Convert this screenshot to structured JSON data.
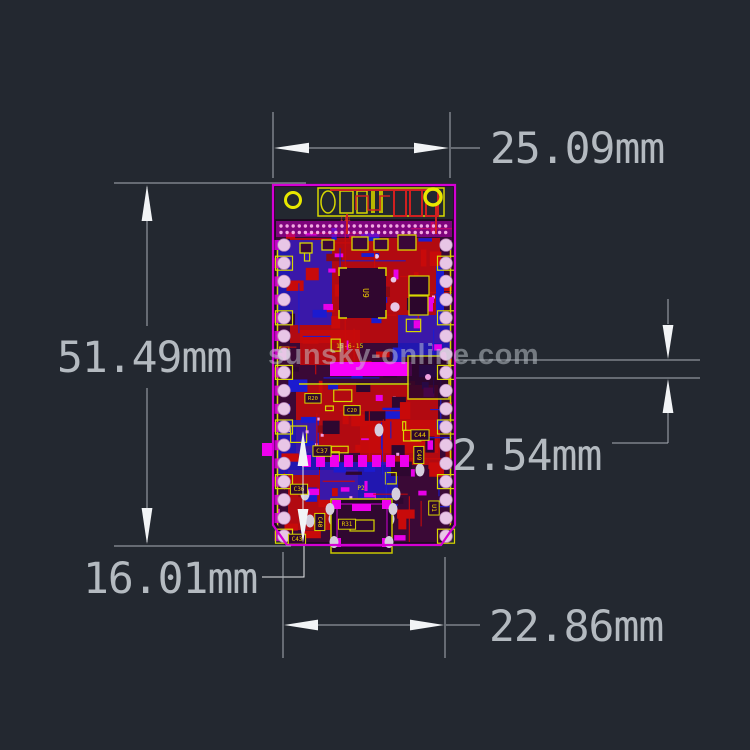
{
  "page": {
    "bg_color": "#232830",
    "description": "CAD dimensional drawing of an ESP32 module PCB layout"
  },
  "watermark": {
    "text": "sunsky-online.com",
    "color": "rgba(198,203,209,0.5)"
  },
  "dimensions": {
    "text_color": "#b4bac0",
    "line_color": "#a8aeb6",
    "arrow_color": "#f2f4f6",
    "top_width": {
      "label": "25.09mm"
    },
    "left_height": {
      "label": "51.49mm"
    },
    "right_pitch": {
      "label": "2.54mm"
    },
    "bottom_left_offset": {
      "label": "16.01mm"
    },
    "bottom_width": {
      "label": "22.86mm"
    }
  },
  "board": {
    "outline_color": "#d400d4",
    "silkscreen_color": "#d8d800",
    "copper_top_color": "#c80a0a",
    "copper_bottom_color": "#1b1bd0",
    "pad_color": "#ee00ee",
    "hole_pad_color": "#e8c6e6",
    "antenna_text": "III",
    "chip_label": "15-6-15",
    "refdes_labels": [
      {
        "text": "U9",
        "x": 363,
        "y": 293,
        "rot": 90,
        "size": 8,
        "boxed": false
      },
      {
        "text": "C44",
        "x": 420,
        "y": 437,
        "rot": 0,
        "size": 6.5,
        "boxed": true
      },
      {
        "text": "C49",
        "x": 417,
        "y": 455,
        "rot": 90,
        "size": 6,
        "boxed": true
      },
      {
        "text": "C37",
        "x": 322,
        "y": 453,
        "rot": 0,
        "size": 6.5,
        "boxed": true
      },
      {
        "text": "C36",
        "x": 299,
        "y": 491,
        "rot": 0,
        "size": 6,
        "boxed": true
      },
      {
        "text": "C40",
        "x": 318,
        "y": 522,
        "rot": 90,
        "size": 6,
        "boxed": true
      },
      {
        "text": "C43",
        "x": 297,
        "y": 541,
        "rot": 0,
        "size": 6,
        "boxed": true
      },
      {
        "text": "R31",
        "x": 347,
        "y": 526,
        "rot": 0,
        "size": 6,
        "boxed": true
      },
      {
        "text": "U1",
        "x": 432,
        "y": 508,
        "rot": 90,
        "size": 6.5,
        "boxed": true
      },
      {
        "text": "P2",
        "x": 361,
        "y": 490,
        "rot": 0,
        "size": 6,
        "boxed": false
      },
      {
        "text": "R20",
        "x": 313,
        "y": 400,
        "rot": 0,
        "size": 5.5,
        "boxed": true
      },
      {
        "text": "C20",
        "x": 352,
        "y": 412,
        "rot": 0,
        "size": 5.5,
        "boxed": true
      }
    ]
  }
}
